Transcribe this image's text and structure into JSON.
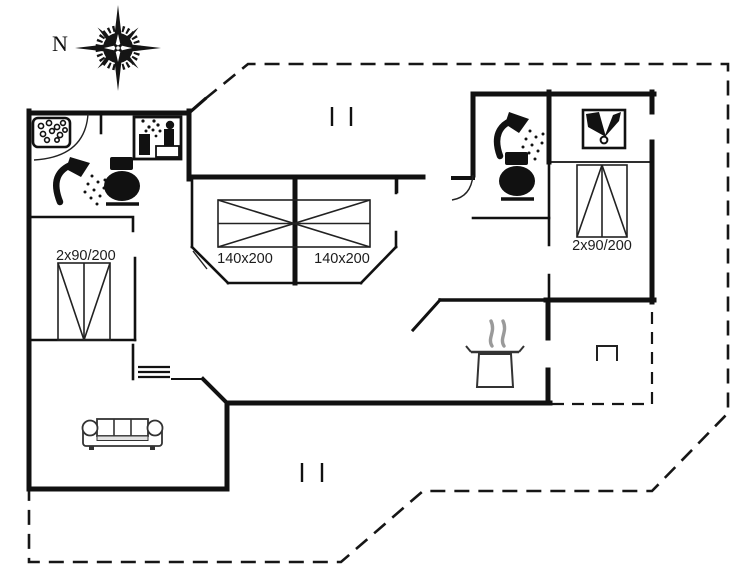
{
  "compass": {
    "north_label": "N"
  },
  "rooms": {
    "bedroom_left": {
      "bed_label": "2x90/200"
    },
    "bedroom_center_left": {
      "bed_label": "140x200"
    },
    "bedroom_center_right": {
      "bed_label": "140x200"
    },
    "bedroom_right": {
      "bed_label": "2x90/200"
    }
  },
  "icons": [
    "compass-rose-icon",
    "whirlpool-icon",
    "sauna-icon",
    "shower-icon-left",
    "toilet-icon-left",
    "shower-icon-right",
    "toilet-icon-right",
    "tv-antenna-icon",
    "cooking-pot-icon",
    "sofa-icon",
    "bed-twin-left-icon",
    "bed-double-icon",
    "bed-twin-right-icon",
    "stairs-symbol",
    "hatch-symbol",
    "vent-marks"
  ],
  "colors": {
    "wall": "#161616",
    "steam": "#9a9a9a",
    "background": "#ffffff"
  }
}
